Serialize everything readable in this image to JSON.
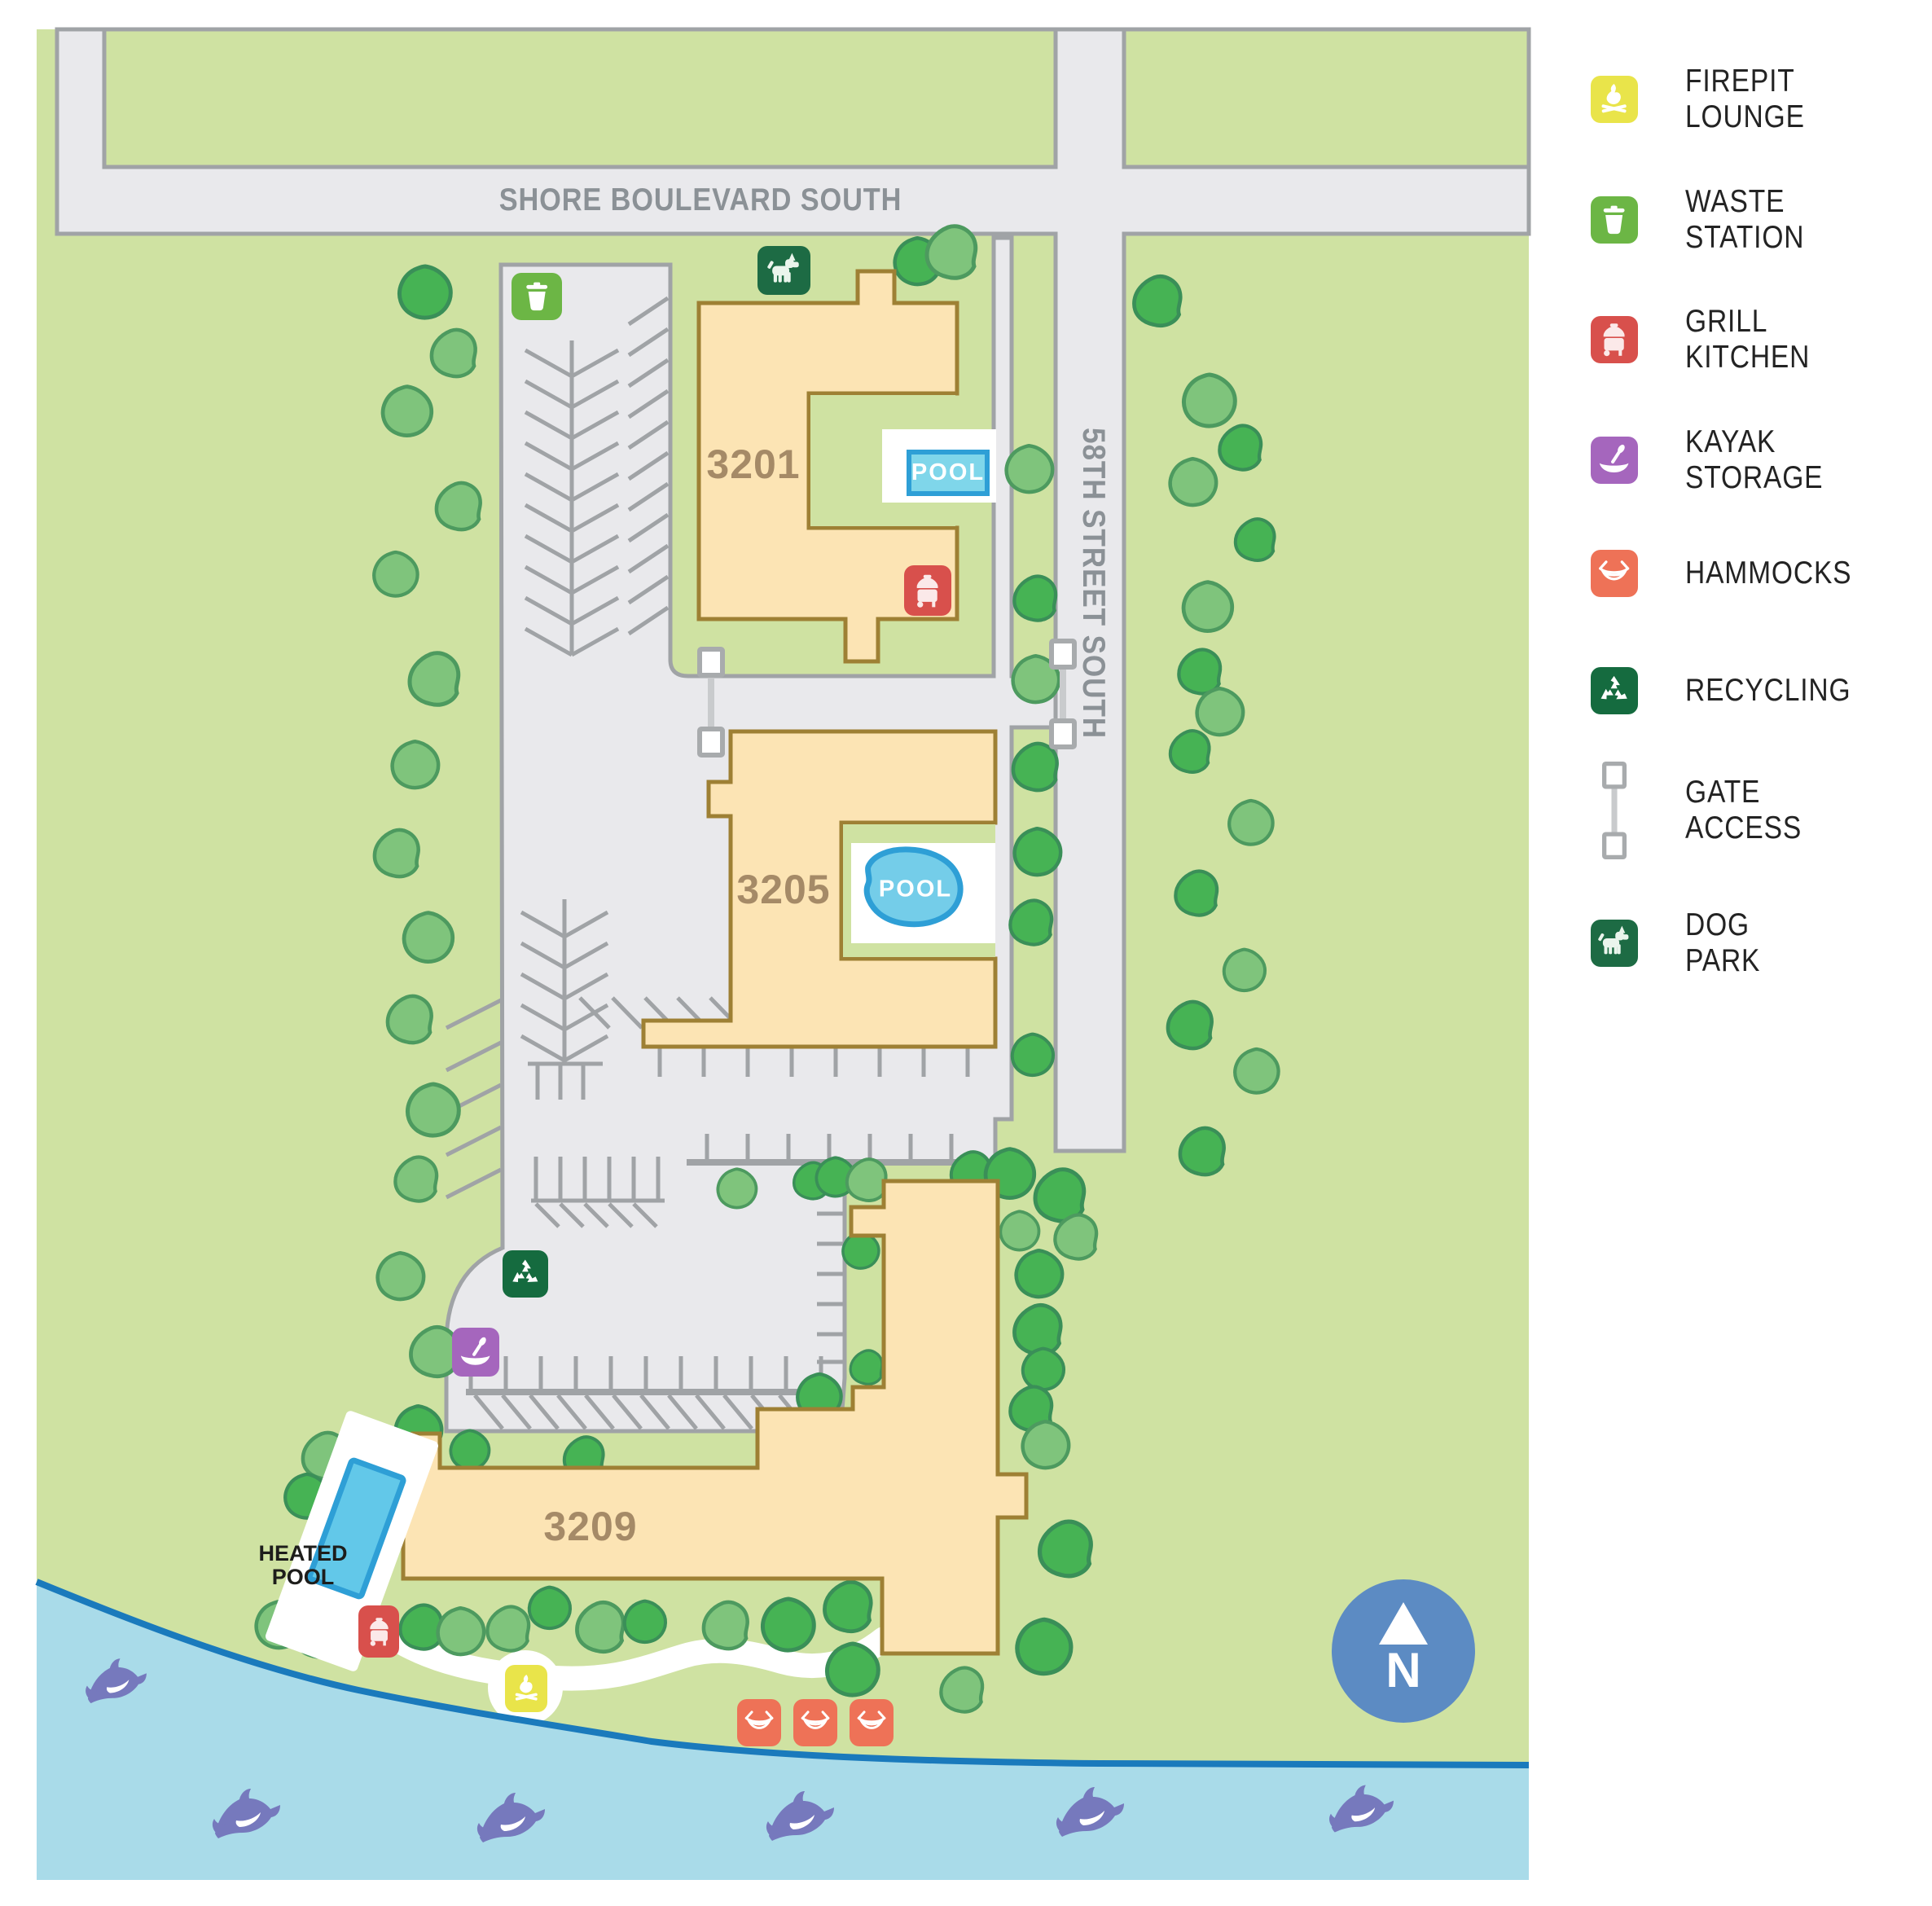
{
  "legend": {
    "items": [
      {
        "id": "firepit-lounge",
        "label": "FIREPIT LOUNGE",
        "color": "#e9e44a"
      },
      {
        "id": "waste-station",
        "label": "WASTE STATION",
        "color": "#6cb645"
      },
      {
        "id": "grill-kitchen",
        "label": "GRILL KITCHEN",
        "color": "#d8504c"
      },
      {
        "id": "kayak-storage",
        "label": "KAYAK STORAGE",
        "color": "#a566bd"
      },
      {
        "id": "hammocks",
        "label": "HAMMOCKS",
        "color": "#ee7257"
      },
      {
        "id": "recycling",
        "label": "RECYCLING",
        "color": "#156b3f"
      },
      {
        "id": "gate-access",
        "label": "GATE ACCESS",
        "color": "#b9bcbe"
      },
      {
        "id": "dog-park",
        "label": "DOG PARK",
        "color": "#1d6b44"
      }
    ]
  },
  "streets": {
    "shore_boulevard": "SHORE BOULEVARD SOUTH",
    "street_58": "58TH STREET SOUTH"
  },
  "buildings": {
    "b3201": "3201",
    "b3205": "3205",
    "b3209": "3209"
  },
  "pools": {
    "pool_3201": "POOL",
    "pool_3205": "POOL",
    "heated_pool": "HEATED POOL"
  },
  "compass": {
    "label": "N"
  },
  "map_markers": [
    {
      "type": "waste-station"
    },
    {
      "type": "dog-park"
    },
    {
      "type": "grill-kitchen"
    },
    {
      "type": "gate-access"
    },
    {
      "type": "gate-access"
    },
    {
      "type": "recycling"
    },
    {
      "type": "kayak-storage"
    },
    {
      "type": "grill-kitchen"
    },
    {
      "type": "firepit-lounge"
    },
    {
      "type": "hammocks"
    },
    {
      "type": "hammocks"
    },
    {
      "type": "hammocks"
    }
  ],
  "colors": {
    "map_green": "#cfe2a2",
    "road_gray": "#e9e9ec",
    "road_edge": "#a0a3a6",
    "building_fill": "#fce4b4",
    "building_edge": "#9e8034",
    "building_label": "#a58a67",
    "water": "#a9dbe9",
    "shoreline": "#1a7abc",
    "dolphin": "#7679bd",
    "pool_fill": "#74cde9",
    "pool_edge": "#2e9fd6",
    "compass_blue": "#5c8bc3",
    "tree_dark": "#46b354",
    "tree_light": "#7fc47c",
    "street_label": "#8b9196"
  }
}
